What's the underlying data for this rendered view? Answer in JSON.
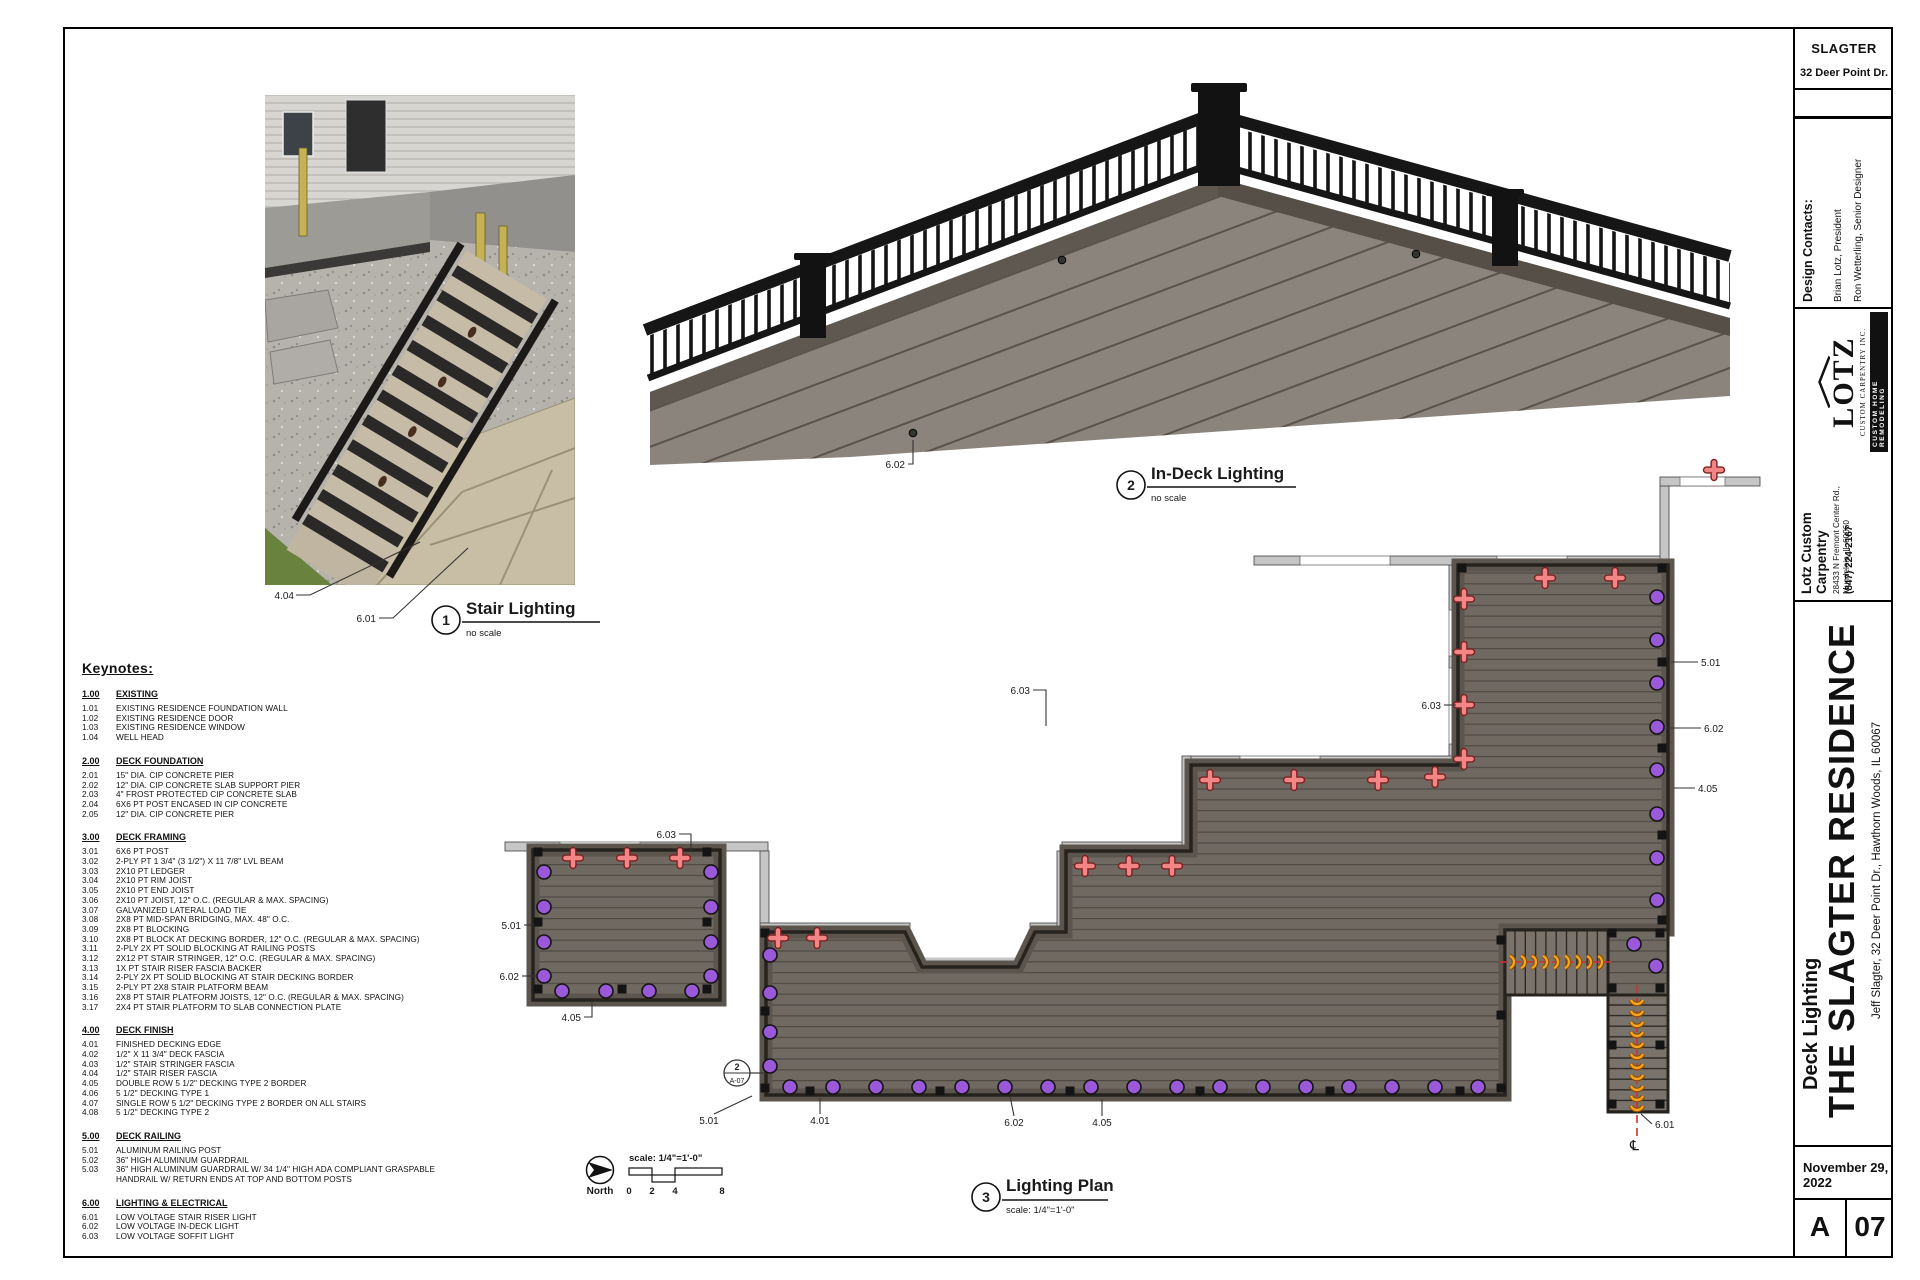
{
  "titleblock": {
    "project": "SLAGTER",
    "project_address": "32 Deer Point Dr.",
    "design_contacts_label": "Design Contacts:",
    "contact_1": "Brian Lotz, President",
    "contact_2": "Ron Wetterling, Senior Designer",
    "logo": {
      "name": "LOTZ",
      "sub": "CUSTOM CARPENTRY INC.",
      "badge": "CUSTOM HOME REMODELING"
    },
    "company_name": "Lotz Custom Carpentry",
    "company_address_1": "28433 N Fremont Center Rd.,",
    "company_address_2": "Mundelein, IL 60060",
    "company_phone": "(847) 224-2167",
    "sheet_title": "Deck Lighting",
    "residence_title": "THE SLAGTER RESIDENCE",
    "client_line": "Jeff Slagter, 32 Deer Point Dr., Hawthorn Woods, IL 60067",
    "date": "November 29, 2022",
    "sheet_series": "A",
    "sheet_number": "07"
  },
  "views": [
    {
      "num": "1",
      "title": "Stair Lighting",
      "scale": "no scale"
    },
    {
      "num": "2",
      "title": "In-Deck Lighting",
      "scale": "no scale"
    },
    {
      "num": "3",
      "title": "Lighting Plan",
      "scale": "scale: 1/4\"=1'-0\""
    }
  ],
  "north": {
    "label": "North"
  },
  "scalebar": {
    "label": "scale: 1/4\"=1'-0\"",
    "ticks": [
      "0",
      "2",
      "4",
      "8"
    ]
  },
  "keynotes": {
    "title": "Keynotes:",
    "sections": [
      {
        "num": "1.00",
        "title": "EXISTING",
        "items": [
          {
            "num": "1.01",
            "text": "EXISTING RESIDENCE FOUNDATION WALL"
          },
          {
            "num": "1.02",
            "text": "EXISTING RESIDENCE DOOR"
          },
          {
            "num": "1.03",
            "text": "EXISTING RESIDENCE WINDOW"
          },
          {
            "num": "1.04",
            "text": "WELL HEAD"
          }
        ]
      },
      {
        "num": "2.00",
        "title": "DECK FOUNDATION",
        "items": [
          {
            "num": "2.01",
            "text": "15\" DIA. CIP CONCRETE PIER"
          },
          {
            "num": "2.02",
            "text": "12\" DIA. CIP CONCRETE SLAB SUPPORT PIER"
          },
          {
            "num": "2.03",
            "text": "4\" FROST PROTECTED CIP CONCRETE SLAB"
          },
          {
            "num": "2.04",
            "text": "6X6 PT POST ENCASED IN CIP CONCRETE"
          },
          {
            "num": "2.05",
            "text": "12\" DIA. CIP CONCRETE PIER"
          }
        ]
      },
      {
        "num": "3.00",
        "title": "DECK FRAMING",
        "items": [
          {
            "num": "3.01",
            "text": "6X6 PT POST"
          },
          {
            "num": "3.02",
            "text": "2-PLY PT 1 3/4\" (3 1/2\") X 11 7/8\" LVL BEAM"
          },
          {
            "num": "3.03",
            "text": "2X10 PT LEDGER"
          },
          {
            "num": "3.04",
            "text": "2X10 PT RIM JOIST"
          },
          {
            "num": "3.05",
            "text": "2X10 PT END JOIST"
          },
          {
            "num": "3.06",
            "text": "2X10 PT JOIST, 12\" O.C. (REGULAR & MAX. SPACING)"
          },
          {
            "num": "3.07",
            "text": "GALVANIZED LATERAL LOAD TIE"
          },
          {
            "num": "3.08",
            "text": "2X8 PT MID-SPAN BRIDGING, MAX. 48\" O.C."
          },
          {
            "num": "3.09",
            "text": "2X8 PT BLOCKING"
          },
          {
            "num": "3.10",
            "text": "2X8 PT BLOCK AT DECKING BORDER, 12\" O.C. (REGULAR & MAX. SPACING)"
          },
          {
            "num": "3.11",
            "text": "2-PLY 2X PT SOLID BLOCKING AT RAILING POSTS"
          },
          {
            "num": "3.12",
            "text": "2X12 PT STAIR STRINGER, 12\" O.C. (REGULAR & MAX. SPACING)"
          },
          {
            "num": "3.13",
            "text": "1X PT STAIR RISER FASCIA BACKER"
          },
          {
            "num": "3.14",
            "text": "2-PLY 2X PT SOLID BLOCKING AT STAIR DECKING BORDER"
          },
          {
            "num": "3.15",
            "text": "2-PLY PT 2X8 STAIR PLATFORM BEAM"
          },
          {
            "num": "3.16",
            "text": "2X8 PT STAIR PLATFORM JOISTS, 12\" O.C. (REGULAR & MAX. SPACING)"
          },
          {
            "num": "3.17",
            "text": "2X4 PT STAIR PLATFORM TO SLAB CONNECTION PLATE"
          }
        ]
      },
      {
        "num": "4.00",
        "title": "DECK FINISH",
        "items": [
          {
            "num": "4.01",
            "text": "FINISHED DECKING EDGE"
          },
          {
            "num": "4.02",
            "text": "1/2\" X 11 3/4\" DECK FASCIA"
          },
          {
            "num": "4.03",
            "text": "1/2\" STAIR STRINGER FASCIA"
          },
          {
            "num": "4.04",
            "text": "1/2\" STAIR RISER FASCIA"
          },
          {
            "num": "4.05",
            "text": "DOUBLE ROW 5 1/2\" DECKING TYPE 2 BORDER"
          },
          {
            "num": "4.06",
            "text": "5 1/2\" DECKING TYPE 1"
          },
          {
            "num": "4.07",
            "text": "SINGLE ROW 5 1/2\" DECKING TYPE 2 BORDER ON ALL STAIRS"
          },
          {
            "num": "4.08",
            "text": "5 1/2\" DECKING TYPE 2"
          }
        ]
      },
      {
        "num": "5.00",
        "title": "DECK RAILING",
        "items": [
          {
            "num": "5.01",
            "text": "ALUMINUM RAILING POST"
          },
          {
            "num": "5.02",
            "text": "36\" HIGH ALUMINUM GUARDRAIL"
          },
          {
            "num": "5.03",
            "text": "36\" HIGH ALUMINUM GUARDRAIL W/ 34 1/4\" HIGH ADA COMPLIANT GRASPABLE HANDRAIL W/ RETURN ENDS AT TOP AND BOTTOM POSTS"
          }
        ]
      },
      {
        "num": "6.00",
        "title": "LIGHTING & ELECTRICAL",
        "items": [
          {
            "num": "6.01",
            "text": "LOW VOLTAGE STAIR RISER LIGHT"
          },
          {
            "num": "6.02",
            "text": "LOW VOLTAGE IN-DECK LIGHT"
          },
          {
            "num": "6.03",
            "text": "LOW VOLTAGE SOFFIT LIGHT"
          }
        ]
      }
    ]
  },
  "plan": {
    "centerline_symbol": "℄",
    "section_marker": {
      "top": "2",
      "bottom": "A-07"
    },
    "labels": [
      {
        "t": "4.04",
        "x": 294,
        "y": 599,
        "a": "end",
        "pts": "296,595 310,595 420,542"
      },
      {
        "t": "6.01",
        "x": 376,
        "y": 622,
        "a": "end",
        "pts": "379,618 393,618 468,548"
      },
      {
        "t": "6.02",
        "x": 905,
        "y": 468,
        "a": "end",
        "pts": "908,464 913,464 913,440"
      },
      {
        "t": "6.03",
        "x": 676,
        "y": 838,
        "a": "end",
        "pts": "679,834 691,834 691,852"
      },
      {
        "t": "5.01",
        "x": 521,
        "y": 929,
        "a": "end",
        "pts": "524,925 534,925"
      },
      {
        "t": "6.02",
        "x": 519,
        "y": 980,
        "a": "end",
        "pts": "522,976 538,976"
      },
      {
        "t": "4.05",
        "x": 581,
        "y": 1021,
        "a": "end",
        "pts": "584,1017 592,1017 592,1002"
      },
      {
        "t": "6.03",
        "x": 1030,
        "y": 694,
        "a": "end",
        "pts": "1033,690 1046,690 1046,726"
      },
      {
        "t": "6.03",
        "x": 1441,
        "y": 709,
        "a": "end",
        "pts": "1444,705 1456,705"
      },
      {
        "t": "5.01",
        "x": 1701,
        "y": 666,
        "a": "start",
        "pts": "1698,662 1671,662"
      },
      {
        "t": "6.02",
        "x": 1704,
        "y": 732,
        "a": "start",
        "pts": "1701,728 1668,728"
      },
      {
        "t": "4.05",
        "x": 1698,
        "y": 792,
        "a": "start",
        "pts": "1695,788 1674,788"
      },
      {
        "t": "5.01",
        "x": 709,
        "y": 1124,
        "a": "middle",
        "pts": "714,1114 752,1096"
      },
      {
        "t": "4.01",
        "x": 820,
        "y": 1124,
        "a": "middle",
        "pts": "820,1114 820,1098"
      },
      {
        "t": "6.02",
        "x": 1014,
        "y": 1126,
        "a": "middle",
        "pts": "1014,1116 1010,1096"
      },
      {
        "t": "4.05",
        "x": 1102,
        "y": 1126,
        "a": "middle",
        "pts": "1102,1116 1102,1099"
      },
      {
        "t": "6.01",
        "x": 1655,
        "y": 1128,
        "a": "start",
        "pts": "1652,1124 1641,1114"
      }
    ],
    "lights_indeck": [
      [
        544,
        872
      ],
      [
        544,
        907
      ],
      [
        544,
        942
      ],
      [
        544,
        976
      ],
      [
        711,
        872
      ],
      [
        711,
        907
      ],
      [
        711,
        942
      ],
      [
        711,
        976
      ],
      [
        562,
        991
      ],
      [
        606,
        991
      ],
      [
        649,
        991
      ],
      [
        692,
        991
      ],
      [
        770,
        955
      ],
      [
        770,
        993
      ],
      [
        770,
        1032
      ],
      [
        770,
        1066
      ],
      [
        790,
        1087
      ],
      [
        833,
        1087
      ],
      [
        876,
        1087
      ],
      [
        919,
        1087
      ],
      [
        962,
        1087
      ],
      [
        1005,
        1087
      ],
      [
        1048,
        1087
      ],
      [
        1091,
        1087
      ],
      [
        1134,
        1087
      ],
      [
        1177,
        1087
      ],
      [
        1220,
        1087
      ],
      [
        1263,
        1087
      ],
      [
        1306,
        1087
      ],
      [
        1349,
        1087
      ],
      [
        1392,
        1087
      ],
      [
        1435,
        1087
      ],
      [
        1478,
        1087
      ],
      [
        1657,
        597
      ],
      [
        1657,
        640
      ],
      [
        1657,
        683
      ],
      [
        1657,
        727
      ],
      [
        1657,
        770
      ],
      [
        1657,
        814
      ],
      [
        1657,
        858
      ],
      [
        1657,
        900
      ],
      [
        1634,
        944
      ],
      [
        1656,
        966
      ]
    ],
    "lights_soffit": [
      [
        573,
        858
      ],
      [
        627,
        858
      ],
      [
        680,
        858
      ],
      [
        778,
        938
      ],
      [
        817,
        938
      ],
      [
        1085,
        866
      ],
      [
        1129,
        866
      ],
      [
        1172,
        866
      ],
      [
        1210,
        780
      ],
      [
        1294,
        780
      ],
      [
        1378,
        780
      ],
      [
        1435,
        777
      ],
      [
        1464,
        599
      ],
      [
        1464,
        652
      ],
      [
        1464,
        705
      ],
      [
        1464,
        759
      ],
      [
        1545,
        578
      ],
      [
        1615,
        578
      ],
      [
        1714,
        470
      ]
    ],
    "posts": [
      [
        538,
        852
      ],
      [
        707,
        852
      ],
      [
        538,
        922
      ],
      [
        707,
        922
      ],
      [
        538,
        989
      ],
      [
        707,
        989
      ],
      [
        622,
        989
      ],
      [
        765,
        933
      ],
      [
        765,
        1011
      ],
      [
        765,
        1088
      ],
      [
        810,
        1091
      ],
      [
        940,
        1091
      ],
      [
        1070,
        1091
      ],
      [
        1200,
        1091
      ],
      [
        1330,
        1091
      ],
      [
        1460,
        1091
      ],
      [
        1501,
        940
      ],
      [
        1501,
        1015
      ],
      [
        1501,
        1088
      ],
      [
        1662,
        568
      ],
      [
        1662,
        662
      ],
      [
        1662,
        748
      ],
      [
        1662,
        835
      ],
      [
        1662,
        920
      ],
      [
        1462,
        568
      ],
      [
        1612,
        933
      ],
      [
        1660,
        933
      ],
      [
        1612,
        988
      ],
      [
        1660,
        988
      ],
      [
        1612,
        1045
      ],
      [
        1660,
        1045
      ],
      [
        1612,
        1104
      ],
      [
        1660,
        1104
      ]
    ],
    "riser_lights_h": {
      "y": 962,
      "xs": [
        1512,
        1523,
        1534,
        1545,
        1556,
        1567,
        1578,
        1589,
        1600
      ]
    },
    "riser_lights_v": {
      "x": 1637,
      "ys": [
        1002,
        1013,
        1024,
        1034,
        1045,
        1056,
        1066,
        1077,
        1088,
        1098,
        1108
      ]
    }
  },
  "colors": {
    "light_purple": "#9a59d8",
    "light_red": "#f28585",
    "light_red_outline": "#7c2020",
    "light_orange": "#f7a51c",
    "light_orange_outline": "#8a4a00",
    "deck_fill": "#6f6962",
    "wall_fill": "#c6c6c6",
    "centerline_red": "#d03030"
  }
}
